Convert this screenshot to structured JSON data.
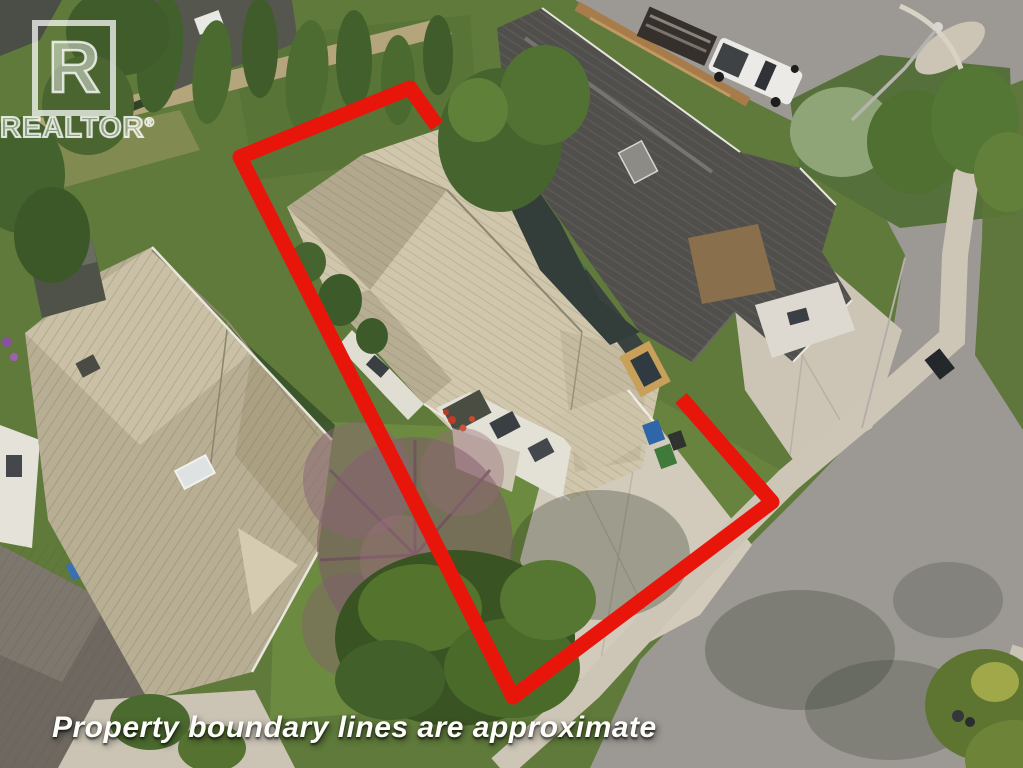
{
  "watermark": {
    "logo_letter": "R",
    "brand": "REALTOR",
    "registered_mark": "®"
  },
  "caption": {
    "text": "Property boundary lines are approximate"
  },
  "boundary": {
    "color": "#e8150b",
    "stroke_width": 15
  },
  "palette": {
    "grass_base": "#5f7a3b",
    "grass_light": "#6f8c43",
    "grass_shadow": "#36502a",
    "road_asphalt": "#9c9894",
    "concrete": "#d2cbbc",
    "sidewalk": "#cdc6b7",
    "dirt_path": "#b5a57c",
    "roof_subject": "#cfc6ac",
    "roof_subject_shade": "#b1a88e",
    "roof_left_house": "#b7ae94",
    "roof_dark_house": "#514f4c",
    "roof_corner_house": "#6e6860",
    "wall_white": "#e3e0d6",
    "wall_dark": "#39423e",
    "tree_green": "#42602c",
    "tree_purple": "#7e5a6a",
    "fence_wood": "#a87c4a",
    "truck_white": "#eceae6"
  }
}
